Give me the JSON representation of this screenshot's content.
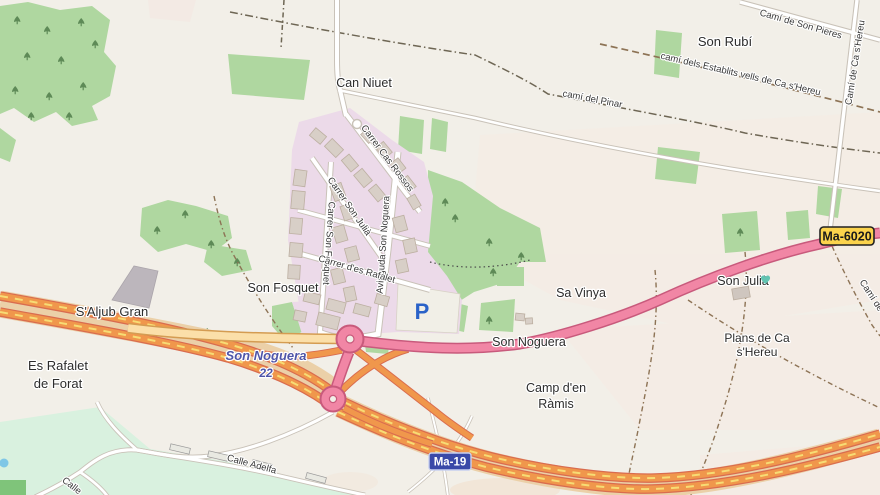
{
  "map": {
    "places": {
      "son_rubi": "Son Rubí",
      "can_niuet": "Can Niuet",
      "son_fosquet": "Son Fosquet",
      "saljub_gran": "S'Aljub Gran",
      "es_rafalet_l1": "Es Rafalet",
      "es_rafalet_l2": "de Forat",
      "sa_vinya": "Sa Vinya",
      "son_noguera": "Son Noguera",
      "camp_den_ramis_l1": "Camp d'en",
      "camp_den_ramis_l2": "Ràmis",
      "son_julia": "Son Julià",
      "plans_l1": "Plans de Ca",
      "plans_l2": "s'Hereu"
    },
    "streets": {
      "cas_rossos": "Carrer Cas Rossos",
      "son_julia": "Carrer Son Julià",
      "son_fosquet": "Carrer Son Fosquet",
      "avinguda": "Avinguda Son Noguera",
      "rafalet": "Carrer d'es Rafalet",
      "calle_adelfa": "Calle Adelfa",
      "calle_partial": "Calle"
    },
    "paths": {
      "son_pieres": "Camí de Son Pieres",
      "establits": "camí dels Establits vells de Ca s'Hereu",
      "ca_shereu": "Camí de Ca s'Hereu",
      "pinar": "camí del Pinar",
      "cami_partial": "Camí de"
    },
    "shields": {
      "ma19": "Ma-19",
      "ma6020": "Ma-6020"
    },
    "junction": {
      "name": "Son Noguera",
      "exit": "22"
    },
    "parking_letter": "P",
    "colors": {
      "land": "#F2EFE8",
      "scrub": "#AFD7A0",
      "industrial": "#ECDAE9",
      "motorway_pink": "#F186A5",
      "motorway_pink_casing": "#C85A7C",
      "construction_orange": "#F0974C",
      "construction_casing": "#D96C4F",
      "construction_dash": "#F7DC74",
      "primary_cream": "#FBDFA9",
      "shield_ma19_bg": "#3A49A8",
      "shield_ma6020_bg": "#FBD34C",
      "parking_blue": "#2A62C8",
      "junction_text": "#4F55A8"
    }
  }
}
